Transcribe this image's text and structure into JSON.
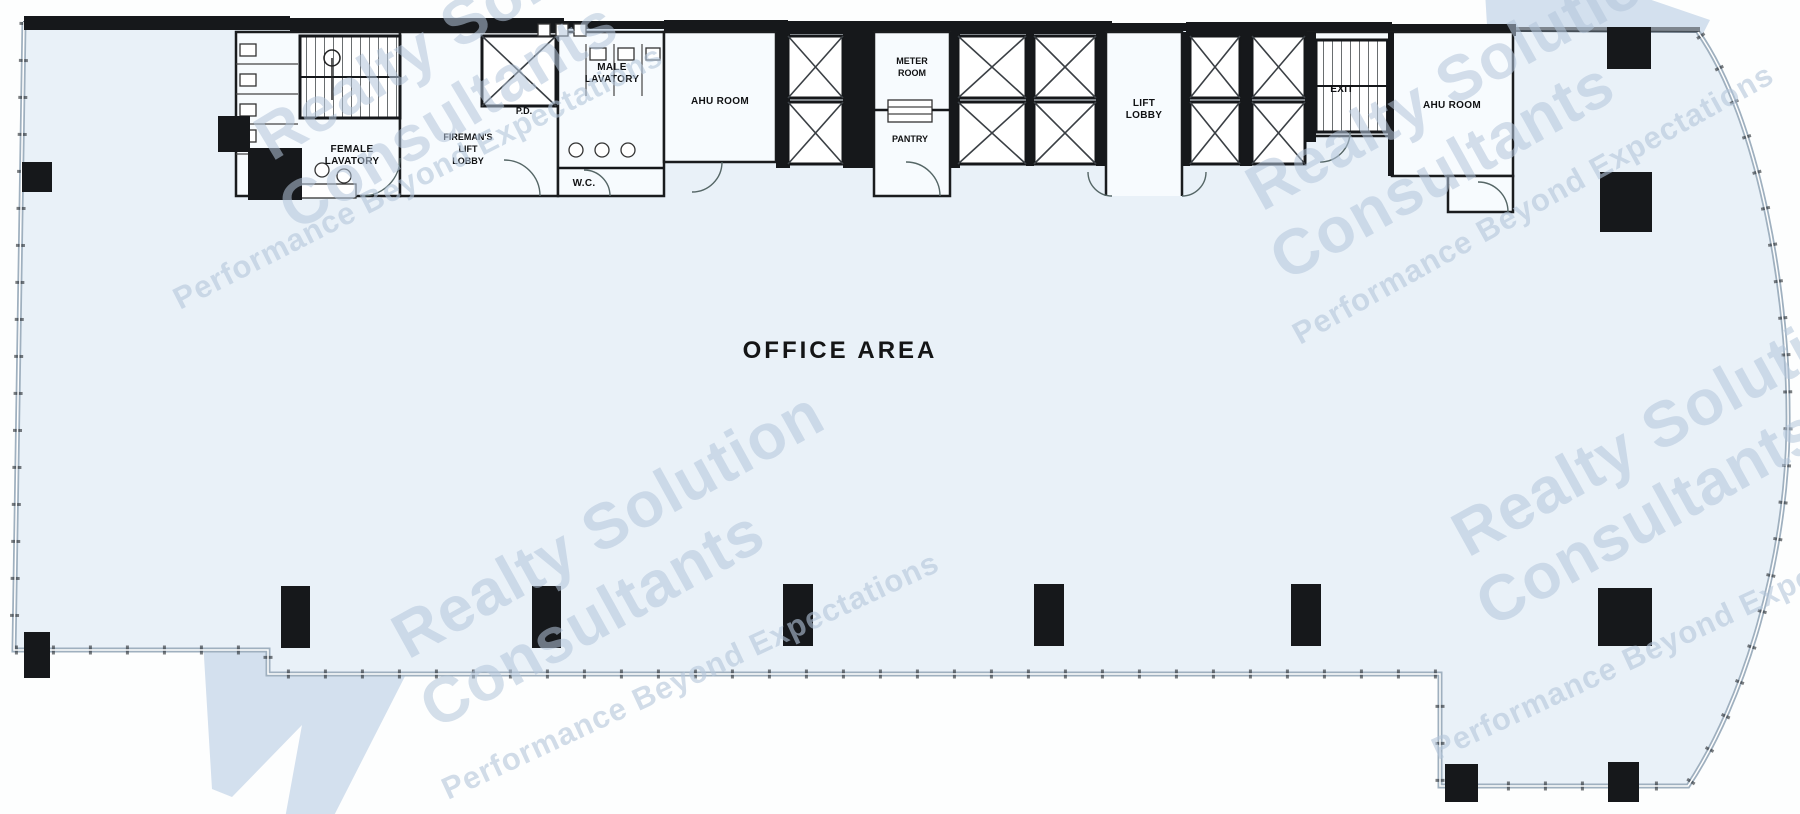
{
  "watermark": {
    "line1": "Realty Solution",
    "line2": "Consultants",
    "tagline": "Performance Beyond Expectations",
    "text_color": "#b4c6db",
    "logo_color": "#aac1dd"
  },
  "plan": {
    "office_area": "OFFICE AREA",
    "labels": {
      "female_lavatory": [
        "FEMALE",
        "LAVATORY"
      ],
      "firemans_lift_lobby": [
        "FIREMAN'S",
        "LIFT",
        "LOBBY"
      ],
      "pd": "P.D.",
      "male_lavatory": [
        "MALE",
        "LAVATORY"
      ],
      "wc": "W.C.",
      "ahu_room_left": "AHU ROOM",
      "meter_room": [
        "METER",
        "ROOM"
      ],
      "pantry": "PANTRY",
      "lift_lobby": [
        "LIFT",
        "LOBBY"
      ],
      "exit": "EXIT",
      "ahu_room_right": "AHU ROOM"
    },
    "colors": {
      "floor": "#e9f1f8",
      "room": "#f7fbfe",
      "wall": "#16181b"
    }
  }
}
